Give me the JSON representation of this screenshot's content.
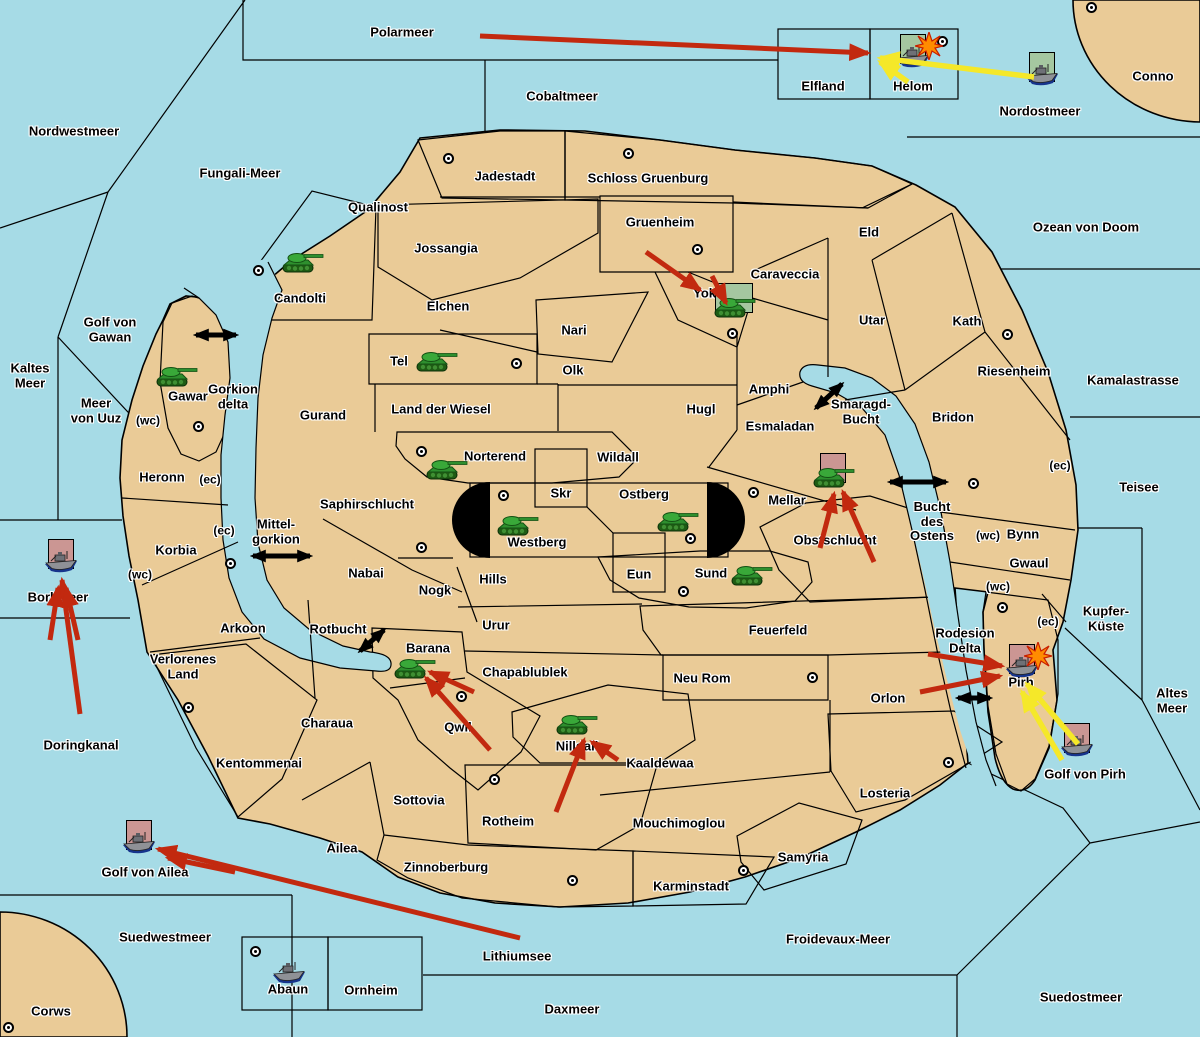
{
  "map": {
    "width": 1200,
    "height": 1037,
    "colors": {
      "sea": "#a6dbe6",
      "land": "#eacb97",
      "green_team": "#a5c7a0",
      "gray_neutral": "#8e8e8e",
      "red_team": "#c28b84",
      "unit_square_pink": "#cb9693",
      "unit_square_green": "#a5c7a0",
      "attack_arrow": "#c2290f",
      "support_arrow": "#f5e829",
      "connection_arrow": "#000000"
    },
    "sea_labels": [
      {
        "text": "Polarmeer",
        "x": 402,
        "y": 33
      },
      {
        "text": "Cobaltmeer",
        "x": 562,
        "y": 97
      },
      {
        "text": "Nordwestmeer",
        "x": 74,
        "y": 132
      },
      {
        "text": "Fungali-Meer",
        "x": 240,
        "y": 174
      },
      {
        "text": "Nordostmeer",
        "x": 1040,
        "y": 112
      },
      {
        "text": "Conno",
        "x": 1153,
        "y": 77
      },
      {
        "text": "Ozean von Doom",
        "x": 1086,
        "y": 228
      },
      {
        "text": "Kamalastrasse",
        "x": 1133,
        "y": 381
      },
      {
        "text": "Teisee",
        "x": 1139,
        "y": 488
      },
      {
        "text": "Kaltes\nMeer",
        "x": 30,
        "y": 376
      },
      {
        "text": "Golf von\nGawan",
        "x": 110,
        "y": 330
      },
      {
        "text": "Meer\nvon Uuz",
        "x": 96,
        "y": 411
      },
      {
        "text": "Gorkion\ndelta",
        "x": 233,
        "y": 397
      },
      {
        "text": "Mittel-\ngorkion",
        "x": 276,
        "y": 532
      },
      {
        "text": "Rotbucht",
        "x": 338,
        "y": 630
      },
      {
        "text": "Smaragd-\nBucht",
        "x": 861,
        "y": 412
      },
      {
        "text": "Bucht\ndes\nOstens",
        "x": 932,
        "y": 522
      },
      {
        "text": "Kupfer-\nKüste",
        "x": 1106,
        "y": 619
      },
      {
        "text": "Altes\nMeer",
        "x": 1172,
        "y": 701
      },
      {
        "text": "Golf von Pirh",
        "x": 1085,
        "y": 775
      },
      {
        "text": "Rodesion\nDelta",
        "x": 965,
        "y": 641
      },
      {
        "text": "Borkmeer",
        "x": 58,
        "y": 598
      },
      {
        "text": "Doringkanal",
        "x": 81,
        "y": 746
      },
      {
        "text": "Golf von Ailea",
        "x": 145,
        "y": 873
      },
      {
        "text": "Suedwestmeer",
        "x": 165,
        "y": 938
      },
      {
        "text": "Corws",
        "x": 51,
        "y": 1012
      },
      {
        "text": "Lithiumsee",
        "x": 517,
        "y": 957
      },
      {
        "text": "Daxmeer",
        "x": 572,
        "y": 1010
      },
      {
        "text": "Froidevaux-Meer",
        "x": 838,
        "y": 940
      },
      {
        "text": "Suedostmeer",
        "x": 1081,
        "y": 998
      }
    ],
    "territory_labels": [
      {
        "text": "Jadestadt",
        "x": 505,
        "y": 177
      },
      {
        "text": "Schloss Gruenburg",
        "x": 648,
        "y": 179
      },
      {
        "text": "Gruenheim",
        "x": 660,
        "y": 223
      },
      {
        "text": "Qualinost",
        "x": 378,
        "y": 208
      },
      {
        "text": "Jossangia",
        "x": 446,
        "y": 249
      },
      {
        "text": "Candolti",
        "x": 300,
        "y": 299
      },
      {
        "text": "Elchen",
        "x": 448,
        "y": 307
      },
      {
        "text": "Nari",
        "x": 574,
        "y": 331
      },
      {
        "text": "Tel",
        "x": 399,
        "y": 362
      },
      {
        "text": "Olk",
        "x": 573,
        "y": 371
      },
      {
        "text": "Gurand",
        "x": 323,
        "y": 416
      },
      {
        "text": "Land der Wiesel",
        "x": 441,
        "y": 410
      },
      {
        "text": "Caraveccia",
        "x": 785,
        "y": 275
      },
      {
        "text": "Yokai",
        "x": 710,
        "y": 294
      },
      {
        "text": "Eld",
        "x": 869,
        "y": 233
      },
      {
        "text": "Utar",
        "x": 872,
        "y": 321
      },
      {
        "text": "Kath",
        "x": 967,
        "y": 322
      },
      {
        "text": "Riesenheim",
        "x": 1014,
        "y": 372
      },
      {
        "text": "Bridon",
        "x": 953,
        "y": 418
      },
      {
        "text": "Amphi",
        "x": 769,
        "y": 390
      },
      {
        "text": "Hugl",
        "x": 701,
        "y": 410
      },
      {
        "text": "Esmaladan",
        "x": 780,
        "y": 427
      },
      {
        "text": "Gawar",
        "x": 188,
        "y": 397
      },
      {
        "text": "Heronn",
        "x": 162,
        "y": 478
      },
      {
        "text": "Korbia",
        "x": 176,
        "y": 551
      },
      {
        "text": "Arkoon",
        "x": 243,
        "y": 629
      },
      {
        "text": "Verlorenes\nLand",
        "x": 183,
        "y": 667
      },
      {
        "text": "Saphirschlucht",
        "x": 367,
        "y": 505
      },
      {
        "text": "Nabai",
        "x": 366,
        "y": 574
      },
      {
        "text": "Norterend",
        "x": 495,
        "y": 457
      },
      {
        "text": "Wildall",
        "x": 618,
        "y": 458
      },
      {
        "text": "Skr",
        "x": 561,
        "y": 494
      },
      {
        "text": "Ostberg",
        "x": 644,
        "y": 495
      },
      {
        "text": "Westberg",
        "x": 537,
        "y": 543
      },
      {
        "text": "Eun",
        "x": 639,
        "y": 575
      },
      {
        "text": "Sund",
        "x": 711,
        "y": 574
      },
      {
        "text": "Hills",
        "x": 493,
        "y": 580
      },
      {
        "text": "Nogk",
        "x": 435,
        "y": 591
      },
      {
        "text": "Mellar",
        "x": 787,
        "y": 501
      },
      {
        "text": "Obstschlucht",
        "x": 835,
        "y": 541
      },
      {
        "text": "Bynn",
        "x": 1023,
        "y": 535
      },
      {
        "text": "Gwaul",
        "x": 1029,
        "y": 564
      },
      {
        "text": "Urur",
        "x": 496,
        "y": 626
      },
      {
        "text": "Chapablublek",
        "x": 525,
        "y": 673
      },
      {
        "text": "Feuerfeld",
        "x": 778,
        "y": 631
      },
      {
        "text": "Neu Rom",
        "x": 702,
        "y": 679
      },
      {
        "text": "Orlon",
        "x": 888,
        "y": 699
      },
      {
        "text": "Barana",
        "x": 428,
        "y": 649
      },
      {
        "text": "Qwil",
        "x": 458,
        "y": 728
      },
      {
        "text": "Nilldall",
        "x": 577,
        "y": 747
      },
      {
        "text": "Kaaldewaa",
        "x": 660,
        "y": 764
      },
      {
        "text": "Sottovia",
        "x": 419,
        "y": 801
      },
      {
        "text": "Rotheim",
        "x": 508,
        "y": 822
      },
      {
        "text": "Kentommenai",
        "x": 259,
        "y": 764
      },
      {
        "text": "Charaua",
        "x": 327,
        "y": 724
      },
      {
        "text": "Ailea",
        "x": 342,
        "y": 849
      },
      {
        "text": "Zinnoberburg",
        "x": 446,
        "y": 868
      },
      {
        "text": "Karminstadt",
        "x": 691,
        "y": 887
      },
      {
        "text": "Mouchimoglou",
        "x": 679,
        "y": 824
      },
      {
        "text": "Samyria",
        "x": 803,
        "y": 858
      },
      {
        "text": "Losteria",
        "x": 885,
        "y": 794
      },
      {
        "text": "Pirh",
        "x": 1021,
        "y": 683
      },
      {
        "text": "Elfland",
        "x": 823,
        "y": 87
      },
      {
        "text": "Helom",
        "x": 913,
        "y": 87
      },
      {
        "text": "Abaun",
        "x": 288,
        "y": 990
      },
      {
        "text": "Ornheim",
        "x": 371,
        "y": 991
      }
    ],
    "coast_markers": [
      {
        "text": "(wc)",
        "x": 148,
        "y": 421
      },
      {
        "text": "(wc)",
        "x": 140,
        "y": 575
      },
      {
        "text": "(wc)",
        "x": 988,
        "y": 536
      },
      {
        "text": "(wc)",
        "x": 998,
        "y": 587
      },
      {
        "text": "(ec)",
        "x": 210,
        "y": 480
      },
      {
        "text": "(ec)",
        "x": 224,
        "y": 531
      },
      {
        "text": "(ec)",
        "x": 1060,
        "y": 466
      },
      {
        "text": "(ec)",
        "x": 1048,
        "y": 622
      }
    ],
    "army_dots": [
      [
        1091,
        7
      ],
      [
        942,
        41
      ],
      [
        448,
        158
      ],
      [
        628,
        153
      ],
      [
        697,
        249
      ],
      [
        732,
        333
      ],
      [
        1007,
        334
      ],
      [
        258,
        270
      ],
      [
        516,
        363
      ],
      [
        198,
        426
      ],
      [
        421,
        451
      ],
      [
        503,
        495
      ],
      [
        690,
        538
      ],
      [
        683,
        591
      ],
      [
        753,
        492
      ],
      [
        973,
        483
      ],
      [
        421,
        547
      ],
      [
        230,
        563
      ],
      [
        1002,
        607
      ],
      [
        188,
        707
      ],
      [
        461,
        696
      ],
      [
        494,
        779
      ],
      [
        812,
        677
      ],
      [
        572,
        880
      ],
      [
        743,
        870
      ],
      [
        948,
        762
      ],
      [
        255,
        951
      ],
      [
        8,
        1027
      ]
    ],
    "units": [
      {
        "type": "tank",
        "x": 302,
        "y": 262,
        "square": null,
        "explosion": false
      },
      {
        "type": "tank",
        "x": 436,
        "y": 361,
        "square": null,
        "explosion": false
      },
      {
        "type": "tank",
        "x": 176,
        "y": 376,
        "square": null,
        "explosion": false
      },
      {
        "type": "tank",
        "x": 446,
        "y": 469,
        "square": null,
        "explosion": false
      },
      {
        "type": "tank",
        "x": 517,
        "y": 525,
        "square": null,
        "explosion": false
      },
      {
        "type": "tank",
        "x": 677,
        "y": 521,
        "square": null,
        "explosion": false
      },
      {
        "type": "tank",
        "x": 751,
        "y": 575,
        "square": null,
        "explosion": false
      },
      {
        "type": "tank",
        "x": 734,
        "y": 307,
        "square": "green",
        "sw": 38,
        "explosion": false
      },
      {
        "type": "tank",
        "x": 833,
        "y": 477,
        "square": "pink",
        "explosion": false
      },
      {
        "type": "tank",
        "x": 414,
        "y": 668,
        "square": null,
        "explosion": false
      },
      {
        "type": "tank",
        "x": 576,
        "y": 724,
        "square": null,
        "explosion": false
      },
      {
        "type": "ship",
        "x": 913,
        "y": 58,
        "square": "green",
        "explosion": true
      },
      {
        "type": "ship",
        "x": 1042,
        "y": 76,
        "square": "green",
        "explosion": false
      },
      {
        "type": "ship",
        "x": 61,
        "y": 563,
        "square": "pink",
        "explosion": false
      },
      {
        "type": "ship",
        "x": 139,
        "y": 844,
        "square": "pink",
        "explosion": false
      },
      {
        "type": "ship",
        "x": 1077,
        "y": 747,
        "square": "pink",
        "explosion": false
      },
      {
        "type": "ship",
        "x": 1022,
        "y": 668,
        "square": "pink",
        "explosion": true
      },
      {
        "type": "ship",
        "x": 289,
        "y": 974,
        "square": null,
        "explosion": false
      }
    ],
    "attack_arrows": [
      {
        "color": "red",
        "x1": 480,
        "y1": 36,
        "x2": 868,
        "y2": 53
      },
      {
        "color": "red",
        "x1": 646,
        "y1": 252,
        "x2": 700,
        "y2": 290
      },
      {
        "color": "red",
        "x1": 712,
        "y1": 276,
        "x2": 726,
        "y2": 303
      },
      {
        "color": "red",
        "x1": 874,
        "y1": 562,
        "x2": 843,
        "y2": 492
      },
      {
        "color": "red",
        "x1": 820,
        "y1": 548,
        "x2": 834,
        "y2": 494
      },
      {
        "color": "red",
        "x1": 490,
        "y1": 750,
        "x2": 426,
        "y2": 678
      },
      {
        "color": "red",
        "x1": 474,
        "y1": 692,
        "x2": 430,
        "y2": 672
      },
      {
        "color": "red",
        "x1": 556,
        "y1": 812,
        "x2": 584,
        "y2": 740
      },
      {
        "color": "red",
        "x1": 618,
        "y1": 760,
        "x2": 592,
        "y2": 742
      },
      {
        "color": "red",
        "x1": 80,
        "y1": 714,
        "x2": 62,
        "y2": 580
      },
      {
        "color": "red",
        "x1": 50,
        "y1": 640,
        "x2": 58,
        "y2": 588
      },
      {
        "color": "red",
        "x1": 78,
        "y1": 640,
        "x2": 66,
        "y2": 588
      },
      {
        "color": "red",
        "x1": 520,
        "y1": 938,
        "x2": 158,
        "y2": 849
      },
      {
        "color": "red",
        "x1": 235,
        "y1": 872,
        "x2": 168,
        "y2": 858
      },
      {
        "color": "red",
        "x1": 928,
        "y1": 654,
        "x2": 1002,
        "y2": 666
      },
      {
        "color": "red",
        "x1": 920,
        "y1": 692,
        "x2": 1000,
        "y2": 676
      },
      {
        "color": "yellow",
        "x1": 1034,
        "y1": 77,
        "x2": 880,
        "y2": 58
      },
      {
        "color": "yellow",
        "x1": 908,
        "y1": 82,
        "x2": 880,
        "y2": 62
      },
      {
        "color": "yellow",
        "x1": 1078,
        "y1": 744,
        "x2": 1027,
        "y2": 684
      },
      {
        "color": "yellow",
        "x1": 1062,
        "y1": 760,
        "x2": 1022,
        "y2": 692
      }
    ],
    "sea_connections": [
      {
        "x1": 196,
        "y1": 335,
        "x2": 236,
        "y2": 335
      },
      {
        "x1": 253,
        "y1": 556,
        "x2": 310,
        "y2": 556
      },
      {
        "x1": 360,
        "y1": 651,
        "x2": 384,
        "y2": 630
      },
      {
        "x1": 816,
        "y1": 408,
        "x2": 842,
        "y2": 384
      },
      {
        "x1": 890,
        "y1": 482,
        "x2": 946,
        "y2": 482
      },
      {
        "x1": 958,
        "y1": 698,
        "x2": 990,
        "y2": 698
      }
    ]
  }
}
